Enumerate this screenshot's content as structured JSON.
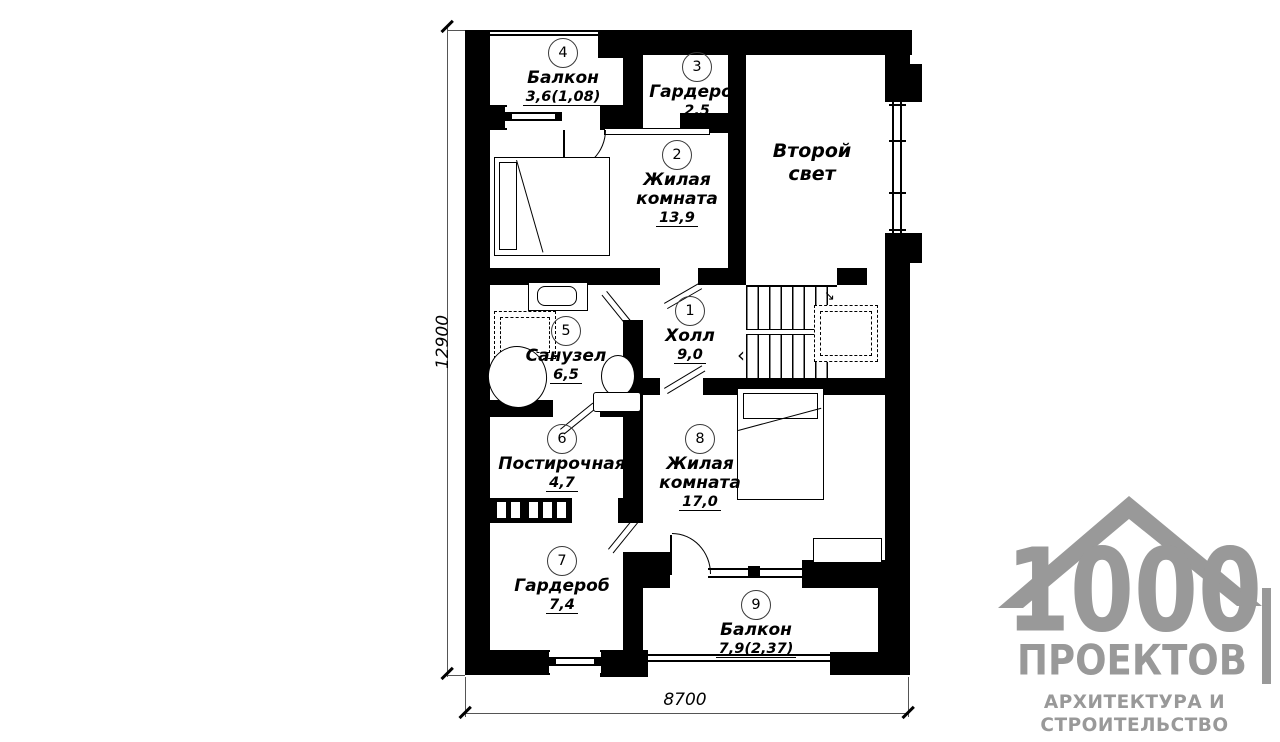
{
  "plan": {
    "rooms": [
      {
        "number": "1",
        "name": "Холл",
        "area": "9,0"
      },
      {
        "number": "2",
        "name": "Жилая комната",
        "area": "13,9"
      },
      {
        "number": "3",
        "name": "Гардероб",
        "area": "2,5"
      },
      {
        "number": "4",
        "name": "Балкон",
        "area": "3,6(1,08)"
      },
      {
        "number": "5",
        "name": "Санузел",
        "area": "6,5"
      },
      {
        "number": "6",
        "name": "Постирочная",
        "area": "4,7"
      },
      {
        "number": "7",
        "name": "Гардероб",
        "area": "7,4"
      },
      {
        "number": "8",
        "name": "Жилая комната",
        "area": "17,0"
      },
      {
        "number": "9",
        "name": "Балкон",
        "area": "7,9(2,37)"
      }
    ],
    "open_space_label": "Второй свет",
    "dimensions": {
      "vertical_mm": "12900",
      "horizontal_mm": "8700"
    }
  },
  "icons": {
    "stairs_direction_arrow": "↘",
    "stairs_start_chevron": "‹"
  },
  "logo": {
    "number": "1000",
    "word": "ПРОЕКТОВ",
    "tagline1": "АРХИТЕКТУРА И",
    "tagline2": "СТРОИТЕЛЬСТВО"
  },
  "colors": {
    "wall": "#000000",
    "logo_gray": "#999999",
    "dim_line": "#555555"
  }
}
